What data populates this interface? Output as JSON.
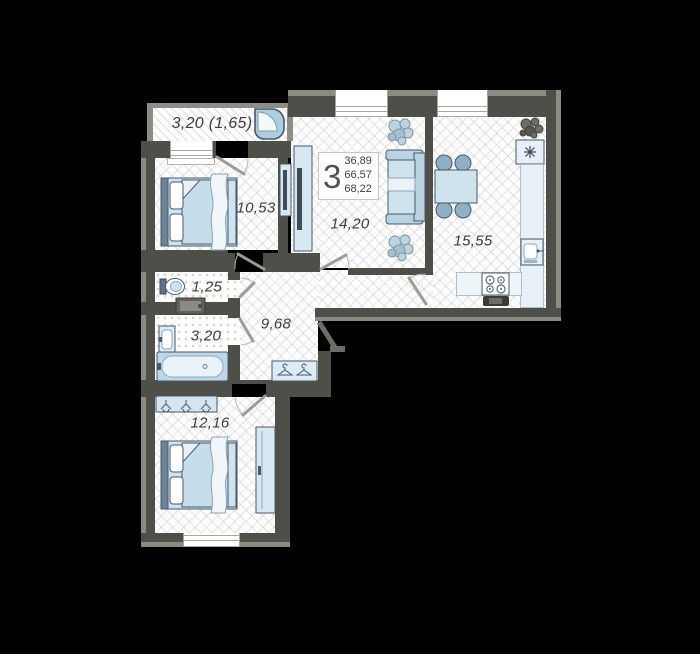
{
  "floor_plan": {
    "unit_rooms_count": "3",
    "area_values": [
      "36,89",
      "66,57",
      "68,22"
    ],
    "rooms": {
      "loggia": "3,20 (1,65)",
      "bedroom_top": "10,53",
      "living_room": "14,20",
      "kitchen": "15,55",
      "wc": "1,25",
      "bathroom": "3,20",
      "hallway": "9,68",
      "bedroom_bottom": "12,16"
    },
    "colors": {
      "background": "#000000",
      "wall": "#4f4f49",
      "wall_light": "#8b8b82",
      "furniture_fill": "#cfe3ee",
      "furniture_stroke": "#47596b",
      "floor": "#fdfdfd",
      "label_text": "#3d3d3d"
    }
  }
}
